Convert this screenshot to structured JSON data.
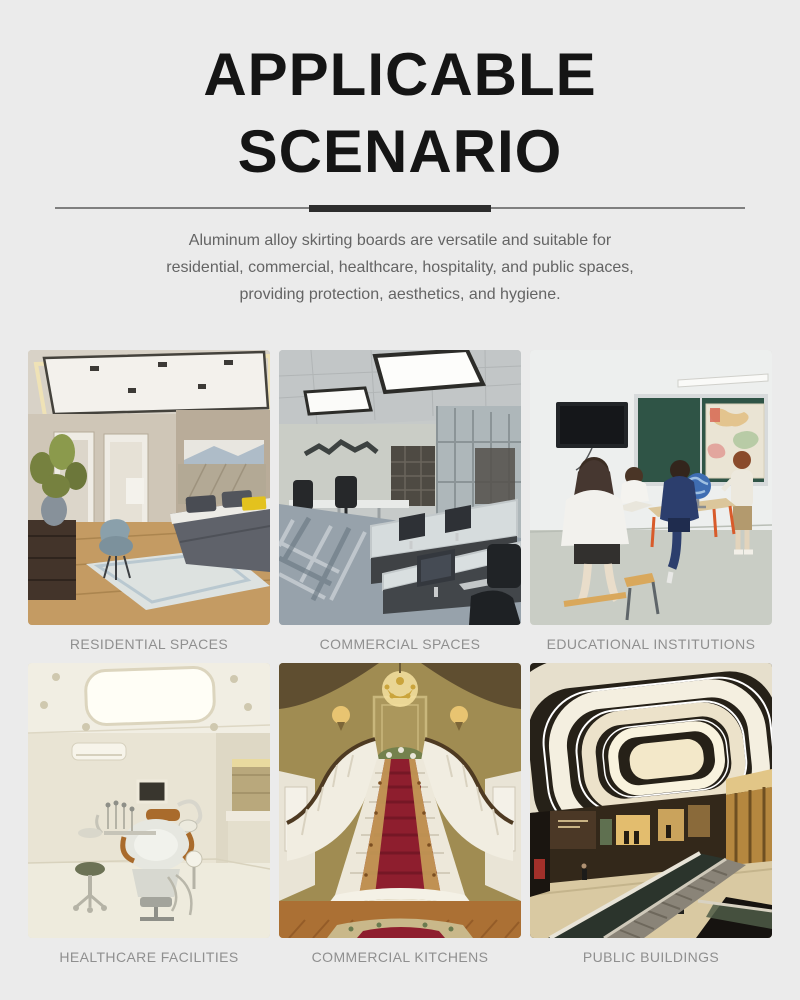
{
  "theme": {
    "page_bg": "#ebebeb",
    "title_color": "#151515",
    "divider_thin_color": "#7f7f7f",
    "divider_thick_color": "#2d2d2d",
    "description_color": "#646464",
    "caption_color": "#8f8f8f"
  },
  "header": {
    "title_line1": "APPLICABLE",
    "title_line2": "SCENARIO",
    "description_lines": [
      "Aluminum alloy skirting boards are versatile and suitable for",
      "residential, commercial, healthcare, hospitality, and public spaces,",
      "providing protection, aesthetics, and hygiene."
    ]
  },
  "scenarios": [
    {
      "label": "RESIDENTIAL SPACES",
      "photo": "residential-bedroom-photo"
    },
    {
      "label": "COMMERCIAL SPACES",
      "photo": "office-workspace-photo"
    },
    {
      "label": "EDUCATIONAL INSTITUTIONS",
      "photo": "classroom-photo"
    },
    {
      "label": "HEALTHCARE FACILITIES",
      "photo": "dental-clinic-photo"
    },
    {
      "label": "COMMERCIAL KITCHENS",
      "photo": "grand-staircase-lobby-photo"
    },
    {
      "label": "PUBLIC BUILDINGS",
      "photo": "shopping-mall-atrium-photo"
    }
  ]
}
